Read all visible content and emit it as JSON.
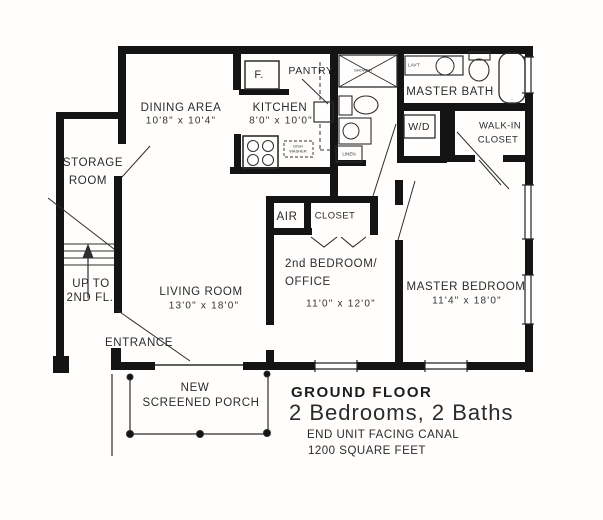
{
  "plan": {
    "rooms": {
      "dining": {
        "name": "DINING AREA",
        "dims": "10'8\" x 10'4\""
      },
      "kitchen": {
        "name": "KITCHEN",
        "dims": "8'0\" x 10'0\""
      },
      "storage": {
        "line1": "STORAGE",
        "line2": "ROOM"
      },
      "living": {
        "name": "LIVING ROOM",
        "dims": "13'0\" x 18'0\""
      },
      "bedroom2": {
        "line1": "2nd BEDROOM/",
        "line2": "OFFICE",
        "dims": "11'0\" x 12'0\""
      },
      "master_bedroom": {
        "name": "MASTER BEDROOM",
        "dims": "11'4\" x 18'0\""
      },
      "master_bath": {
        "name": "MASTER BATH"
      },
      "walkin_closet": {
        "line1": "WALK-IN",
        "line2": "CLOSET"
      },
      "pantry": {
        "name": "PANTRY"
      },
      "air": {
        "name": "AIR"
      },
      "closet": {
        "name": "CLOSET"
      },
      "wd": {
        "name": "W/D"
      },
      "linen": {
        "name": "LINEN"
      },
      "fridge": {
        "name": "F."
      },
      "lav": {
        "name": "LAV'T"
      },
      "shower": {
        "name": "SHOWER"
      },
      "sink_note": {
        "line1": "DISH",
        "line2": "WASHER"
      }
    },
    "stairs": {
      "line1": "UP TO",
      "line2": "2ND FL."
    },
    "entrance": {
      "label": "ENTRANCE"
    },
    "porch": {
      "line1": "NEW",
      "line2": "SCREENED PORCH"
    },
    "title_block": {
      "floor": "GROUND FLOOR",
      "subtitle": "2 Bedrooms, 2 Baths",
      "note1": "END UNIT FACING CANAL",
      "note2": "1200 SQUARE FEET"
    },
    "colors": {
      "wall": "#141414",
      "line": "#2d2d2d",
      "paper": "#fffefd"
    }
  }
}
